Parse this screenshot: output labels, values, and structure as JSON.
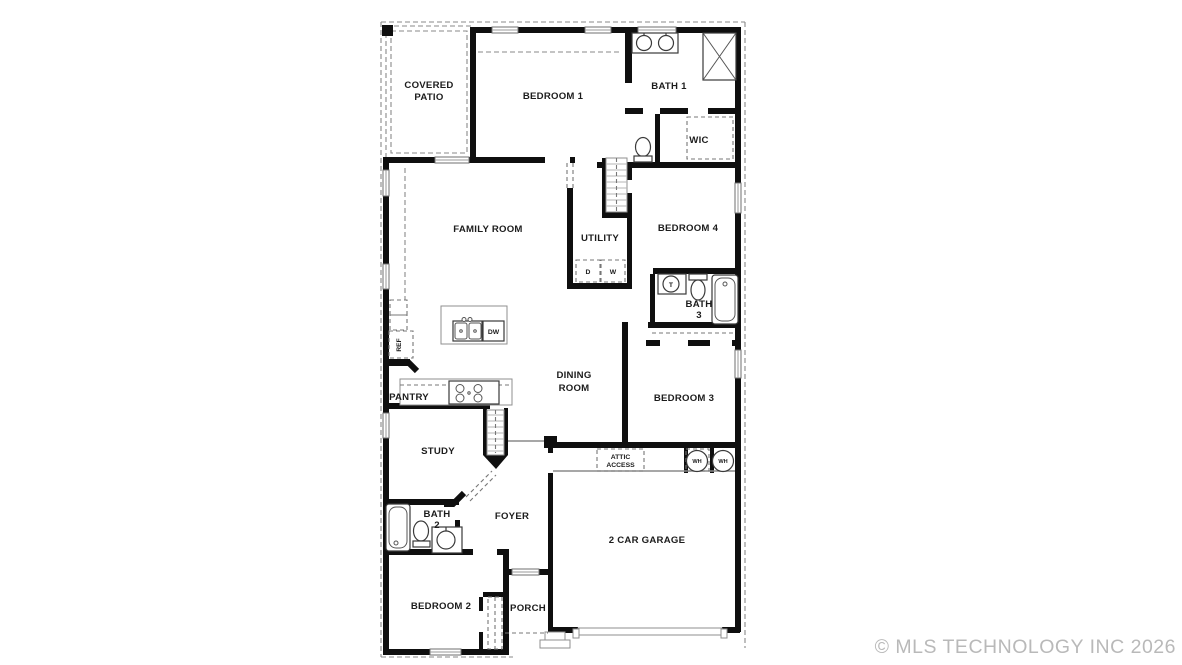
{
  "watermark": {
    "text": "© MLS TECHNOLOGY INC 2026"
  },
  "colors": {
    "background": "#ffffff",
    "wall": "#0f0f0f",
    "fixture_outline": "#3a3a3a",
    "dashed_line": "#8a8a8a",
    "label_text": "#1c1c1c",
    "watermark_text": "#b9b9b9"
  },
  "plan": {
    "rooms": {
      "covered_patio": {
        "line1": "COVERED",
        "line2": "PATIO"
      },
      "bedroom1": {
        "label": "BEDROOM 1"
      },
      "bath1": {
        "label": "BATH 1"
      },
      "wic": {
        "label": "WIC"
      },
      "family_room": {
        "label": "FAMILY ROOM"
      },
      "utility": {
        "label": "UTILITY"
      },
      "bedroom4": {
        "label": "BEDROOM 4"
      },
      "bath3": {
        "line1": "BATH",
        "line2": "3"
      },
      "dining_room": {
        "line1": "DINING",
        "line2": "ROOM"
      },
      "bedroom3": {
        "label": "BEDROOM 3"
      },
      "pantry": {
        "label": "PANTRY"
      },
      "study": {
        "label": "STUDY"
      },
      "bath2": {
        "line1": "BATH",
        "line2": "2"
      },
      "foyer": {
        "label": "FOYER"
      },
      "garage": {
        "label": "2 CAR GARAGE"
      },
      "bedroom2": {
        "label": "BEDROOM 2"
      },
      "porch": {
        "label": "PORCH"
      },
      "attic_access": {
        "line1": "ATTIC",
        "line2": "ACCESS"
      }
    },
    "appliances": {
      "dryer": "D",
      "washer": "W",
      "dishwasher": "DW",
      "refrigerator": "REF",
      "water_heater": "WH",
      "sink_tag": "T"
    }
  }
}
